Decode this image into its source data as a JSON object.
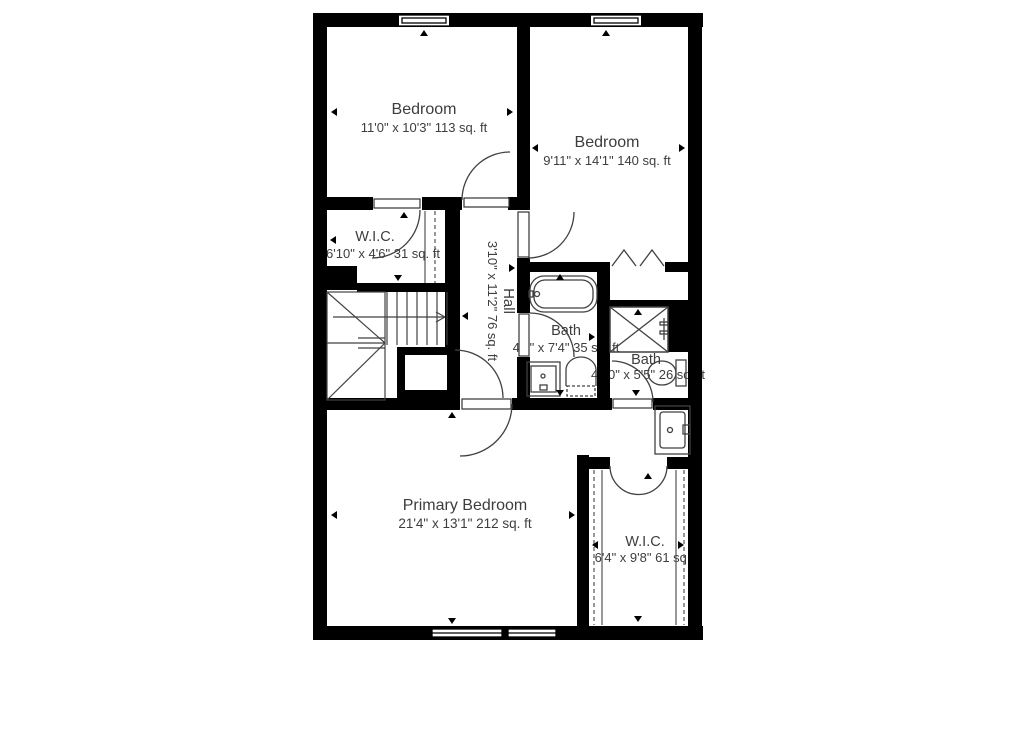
{
  "colors": {
    "walls": "#000000",
    "lines": "#414141",
    "text": "#3d3d3d",
    "background": "#ffffff"
  },
  "rooms": {
    "bedroom1": {
      "name": "Bedroom",
      "dims": "11'0\" x 10'3\" 113 sq. ft"
    },
    "bedroom2": {
      "name": "Bedroom",
      "dims": "9'11\" x 14'1\" 140 sq. ft"
    },
    "wic1": {
      "name": "W.I.C.",
      "dims": "6'10\" x 4'6\" 31 sq. ft"
    },
    "hall": {
      "name": "Hall",
      "dims": "3'10\" x 11'2\" 76 sq. ft"
    },
    "bath1": {
      "name": "Bath",
      "dims": "4'9\" x 7'4\" 35 sq. ft"
    },
    "bath2": {
      "name": "Bath",
      "dims": "4'10\" x 5'5\" 26 sq. ft"
    },
    "primary": {
      "name": "Primary Bedroom",
      "dims": "21'4\" x 13'1\" 212 sq. ft"
    },
    "wic2": {
      "name": "W.I.C.",
      "dims": "6'4\" x 9'8\" 61 sq. ft"
    }
  }
}
